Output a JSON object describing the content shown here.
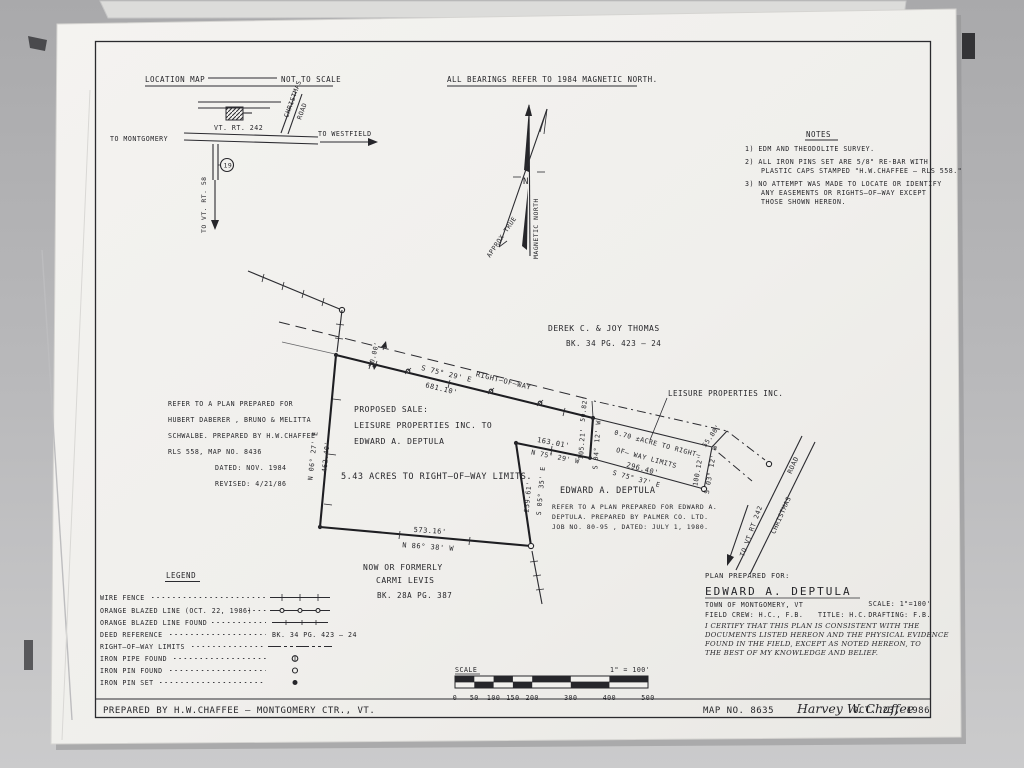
{
  "location_map": {
    "title": "LOCATION MAP",
    "not_to_scale": "NOT TO SCALE",
    "to_montgomery": "TO MONTGOMERY",
    "route": "VT. RT. 242",
    "to_westfield": "TO WESTFIELD",
    "christmas": "CHRISTMAS",
    "road": "ROAD",
    "to_rt58": "TO VT. RT. 58",
    "marker": "19"
  },
  "bearings_note": "ALL BEARINGS REFER TO 1984 MAGNETIC NORTH.",
  "north_arrow": {
    "n": "N",
    "magnetic": "MAGNETIC NORTH",
    "approx_true": "APPROX TRUE"
  },
  "notes": {
    "title": "NOTES",
    "n1": "1)  EDM AND THEODOLITE SURVEY.",
    "n2a": "2)  ALL IRON PINS SET ARE 5/8\" RE-BAR WITH",
    "n2b": "PLASTIC CAPS STAMPED \"H.W.CHAFFEE — RLS 558.\"",
    "n3a": "3)  NO ATTEMPT WAS MADE TO LOCATE OR IDENTIFY",
    "n3b": "ANY EASEMENTS OR RIGHTS—OF—WAY EXCEPT",
    "n3c": "THOSE SHOWN HEREON."
  },
  "abutters": {
    "thomas_name": "DEREK C. & JOY THOMAS",
    "thomas_ref": "BK. 34    PG. 423 — 24",
    "leisure": "LEISURE PROPERTIES INC.",
    "deptula": "EDWARD  A. DEPTULA",
    "carmi_1": "NOW OR FORMERLY",
    "carmi_2": "CARMI LEVIS",
    "carmi_3": "BK. 28A   PG. 387"
  },
  "annotations": {
    "proposed_1": "PROPOSED SALE:",
    "proposed_2": "LEISURE PROPERTIES INC. TO",
    "proposed_3": "EDWARD A. DEPTULA",
    "acreage": "5.43 ACRES TO RIGHT—OF—WAY LIMITS.",
    "strip_1": "0.70 ±ACRE TO RIGHT—",
    "strip_2": "OF— WAY LIMITS",
    "row_label": "RIGHT—OF—WAY",
    "refer_west_1": "REFER TO A PLAN PREPARED FOR",
    "refer_west_2": "HUBERT DABERER ,  BRUNO & MELITTA",
    "refer_west_3": "SCHWALBE. PREPARED BY H.W.CHAFFEE",
    "refer_west_4": "RLS 558, MAP NO. 8436",
    "refer_west_5": "DATED: NOV. 1984",
    "refer_west_6": "REVISED: 4/21/86",
    "refer_dep_1": "REFER TO A PLAN PREPARED FOR EDWARD A.",
    "refer_dep_2": "DEPTULA. PREPARED BY PALMER CO. LTD.",
    "refer_dep_3": "JOB NO. 80-95 ,  DATED: JULY 1, 1980."
  },
  "dimensions": {
    "top_b": "S 75° 29' E",
    "top_d": "681.10'",
    "west_b": "N 06° 27' E",
    "west_d": "462.40'",
    "bottom_d": "573.16'",
    "bottom_b": "N 86° 38' W",
    "east_d": "259.61'",
    "east_b": "S 05° 35' E",
    "jog_d": "163.01'",
    "jog_b": "N 75° 29' W",
    "ne_d": "105.21'",
    "ne_b": "S 04° 12' W",
    "strip_d": "296.40'",
    "strip_b": "S 75° 37' E",
    "strip_e_d": "100.12'",
    "strip_e_b": "S 03° 12' W",
    "row_w": "50.00'",
    "row_e": "50.82'",
    "row_ne": "55.80'"
  },
  "road": {
    "to_vt": "TO VT RT 242",
    "christmas": "CHRISTMAS",
    "road": "ROAD"
  },
  "legend": {
    "title": "LEGEND",
    "items": [
      {
        "label": "WIRE FENCE"
      },
      {
        "label": "ORANGE BLAZED LINE (OCT. 22, 1986)"
      },
      {
        "label": "ORANGE BLAZED LINE FOUND"
      },
      {
        "label": "DEED REFERENCE",
        "value": "BK. 34   PG. 423 — 24"
      },
      {
        "label": "RIGHT—OF—WAY LIMITS"
      },
      {
        "label": "IRON PIPE FOUND"
      },
      {
        "label": "IRON PIN FOUND"
      },
      {
        "label": "IRON PIN SET"
      }
    ]
  },
  "title_block": {
    "prepared_for": "PLAN PREPARED FOR:",
    "name": "EDWARD  A. DEPTULA",
    "town": "TOWN OF MONTGOMERY, VT",
    "scale": "SCALE: 1\"=100'",
    "field_crew": "FIELD CREW: H.C., F.B.",
    "title": "TITLE: H.C.",
    "drafting": "DRAFTING: F.B.",
    "cert_1": "I CERTIFY THAT THIS PLAN IS CONSISTENT WITH THE",
    "cert_2": "DOCUMENTS  LISTED HEREON AND THE  PHYSICAL EVIDENCE",
    "cert_3": "FOUND IN THE FIELD, EXCEPT AS NOTED HEREON, TO",
    "cert_4": "THE BEST OF MY KNOWLEDGE AND BELIEF."
  },
  "scale_bar": {
    "label": "SCALE",
    "ratio": "1\" = 100'",
    "ticks": [
      "0",
      "50",
      "100",
      "150",
      "200",
      "300",
      "400",
      "500"
    ]
  },
  "footer": {
    "prepared_by": "PREPARED BY H.W.CHAFFEE — MONTGOMERY CTR., VT.",
    "map_no": "MAP NO. 8635",
    "signature": "Harvey W. Chaffee",
    "date": "OCT. 23, 1986"
  }
}
